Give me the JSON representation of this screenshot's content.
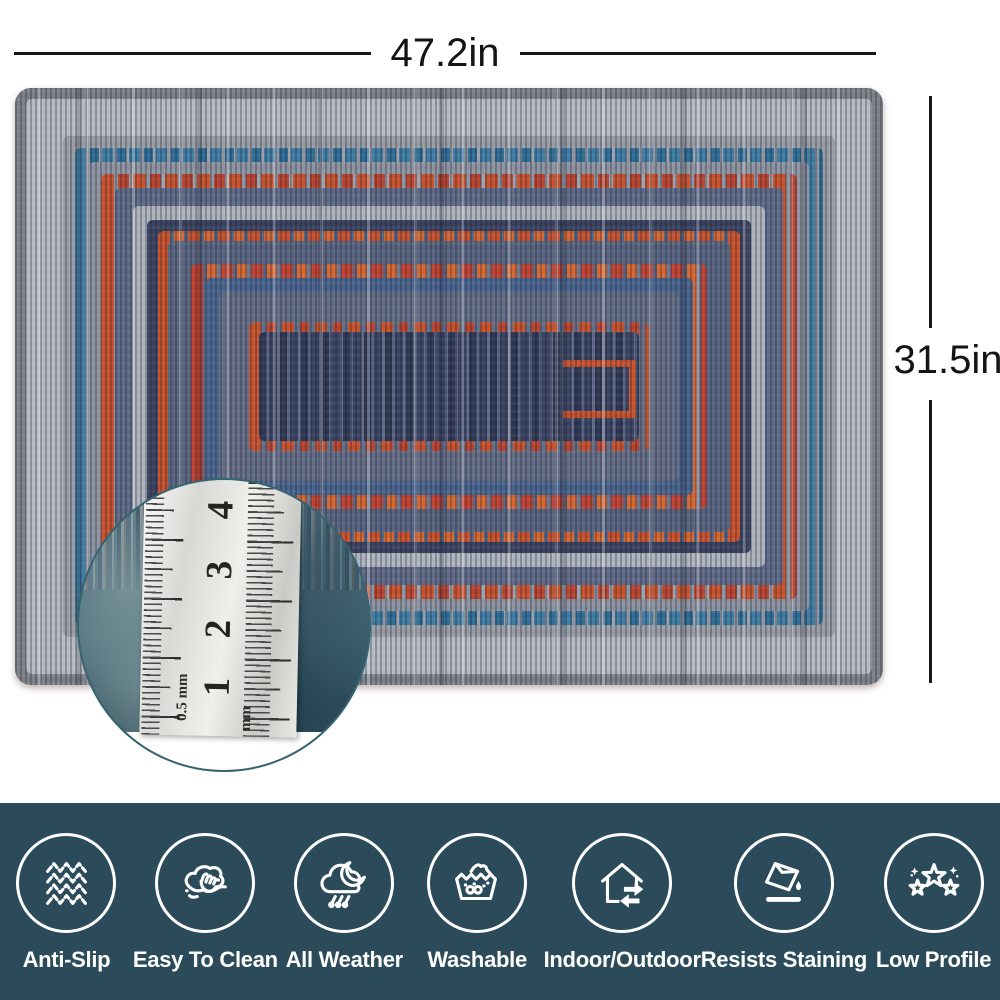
{
  "dimensions": {
    "width_label": "47.2in",
    "height_label": "31.5in"
  },
  "magnifier": {
    "ruler_numbers": [
      "4",
      "3",
      "2",
      "1"
    ],
    "ruler_unit_small": "0.5 mm",
    "ruler_unit": "mm"
  },
  "features": {
    "bar_color": "#2b4b5a",
    "icon_color": "#ffffff",
    "items": [
      {
        "label": "Anti-Slip",
        "icon": "anti-slip-icon"
      },
      {
        "label": "Easy To Clean",
        "icon": "wipe-clean-icon"
      },
      {
        "label": "All Weather",
        "icon": "all-weather-icon"
      },
      {
        "label": "Washable",
        "icon": "washable-icon"
      },
      {
        "label": "Indoor/Outdoor",
        "icon": "indoor-outdoor-icon"
      },
      {
        "label": "Resists Staining",
        "icon": "resists-staining-icon"
      },
      {
        "label": "Low Profile",
        "icon": "low-profile-icon"
      }
    ]
  },
  "rug": {
    "palette": {
      "edge_gray": "#7d8187",
      "light_gray": "#b6bac1",
      "mid_gray": "#8d93a0",
      "teal_blue": "#3f7ca3",
      "orange": "#c7512c",
      "red": "#bf4130",
      "navy": "#3a4260",
      "slate": "#57637f",
      "steel_blue": "#49648c",
      "center_navy": "#343d59"
    }
  }
}
